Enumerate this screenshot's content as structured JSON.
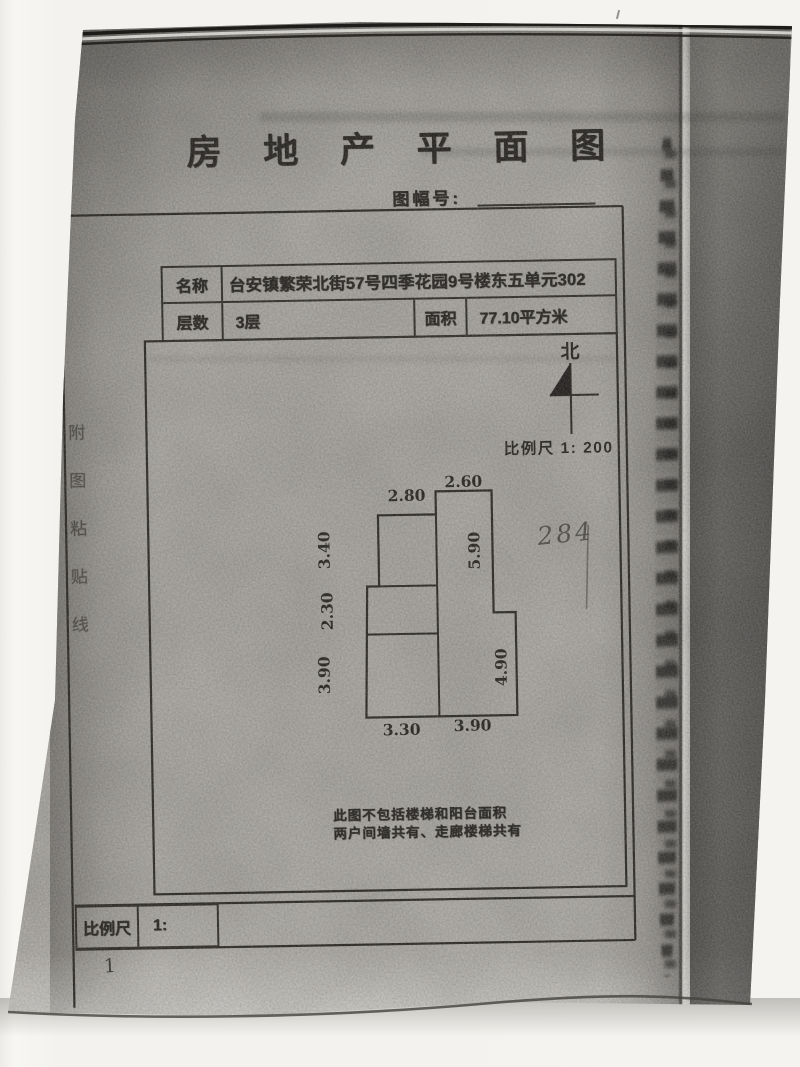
{
  "document": {
    "title": "房 地 产 平 面 图",
    "sheet_no_label": "图幅号:",
    "info_table": {
      "name_label": "名称",
      "name_value": "台安镇繁荣北街57号四季花园9号楼东五单元302",
      "floors_label": "层数",
      "floors_value": "3层",
      "area_label": "面积",
      "area_value": "77.10平方米"
    },
    "compass": {
      "north_label": "北"
    },
    "scale_note": "比例尺 1: 200",
    "plan": {
      "dimensions_top": [
        "2.80",
        "2.60"
      ],
      "dimensions_left": [
        "3.40",
        "2.30",
        "3.90"
      ],
      "dimensions_inner": [
        "5.90",
        "4.90"
      ],
      "dimensions_bottom": [
        "3.30",
        "3.90"
      ]
    },
    "handwritten_note": "284",
    "notes": {
      "line1": "此图不包括楼梯和阳台面积",
      "line2": "两户间墙共有、走廊楼梯共有"
    },
    "side_strip_text": "附图粘贴线",
    "footer": {
      "scale_label": "比例尺",
      "scale_value": "1:",
      "page_number": "1"
    }
  },
  "colors": {
    "paper_gray": "#b0ada7",
    "ink": "#221f1b",
    "fold_shadow": "#55524d",
    "background_white": "#f4f3ef"
  }
}
